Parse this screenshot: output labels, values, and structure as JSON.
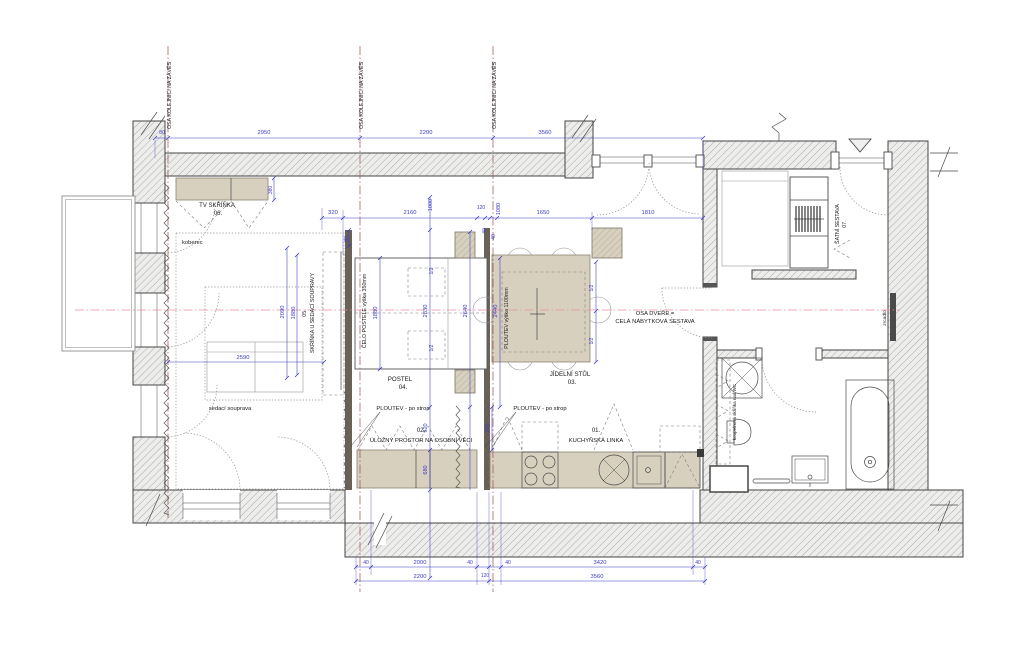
{
  "drawing_type": "apartment furniture floor plan",
  "labels": {
    "osa_rail": "OSA KOLEJNICI NA ZÁVĚS",
    "tv": "TV SKŘÍŇKA",
    "tv_no": "06.",
    "koberec": "koberec",
    "sofa": "sedací souprava",
    "sofa_cab_no": "05.",
    "sofa_cab": "SKŘÍŇKA U SEDACÍ SOUPRAVY",
    "celo": "ČELO POSTELE výška 350mm",
    "postel": "POSTEL",
    "postel_no": "04.",
    "ploutev_v": "PLOUTEV výška 1100mm",
    "stul": "JÍDELNÍ STŮL",
    "stul_no": "03.",
    "osa_dvere_1": "OSA DVEŘE =",
    "osa_dvere_2": "CELÁ NÁBYTKOVÁ SESTAVA",
    "ploutev_strop": "PLOUTEV - po strop",
    "ulozny_no": "02.",
    "ulozny": "ÚLOŽNÝ PROSTOR NA OSOBNÍ VĚCI",
    "kuchyn_no": "01.",
    "kuchyn": "KUCHYŇSKÁ LINKA",
    "satni": "ŠATNÍ SESTAVA",
    "satni_no": "07.",
    "zrcadlo": "zrcadlo",
    "koupelna": "koupelnová skříňka nad WC"
  },
  "dims": {
    "d40": "40",
    "d80": "80",
    "d120": "120",
    "d320": "320",
    "d380": "380",
    "d680": "680",
    "d920": "920",
    "d980": "980",
    "d1000": "1000",
    "d1080": "1080",
    "d1650": "1650",
    "d1810": "1810",
    "d1880": "1880",
    "d2000": "2000",
    "d2090": "2090",
    "d2160": "2160",
    "d2200": "2200",
    "d2440": "2440",
    "d2590": "2590",
    "d2640": "2640",
    "d2830": "2830",
    "d2950": "2950",
    "d3420": "3420",
    "d3560": "3560",
    "dhalf": "1/2"
  },
  "colors": {
    "dim": "#3b3bc4",
    "axis": "#9b4f4f",
    "centerline": "#e58f9f",
    "furniture": "#d8d0bf",
    "wall_line": "#454545"
  }
}
